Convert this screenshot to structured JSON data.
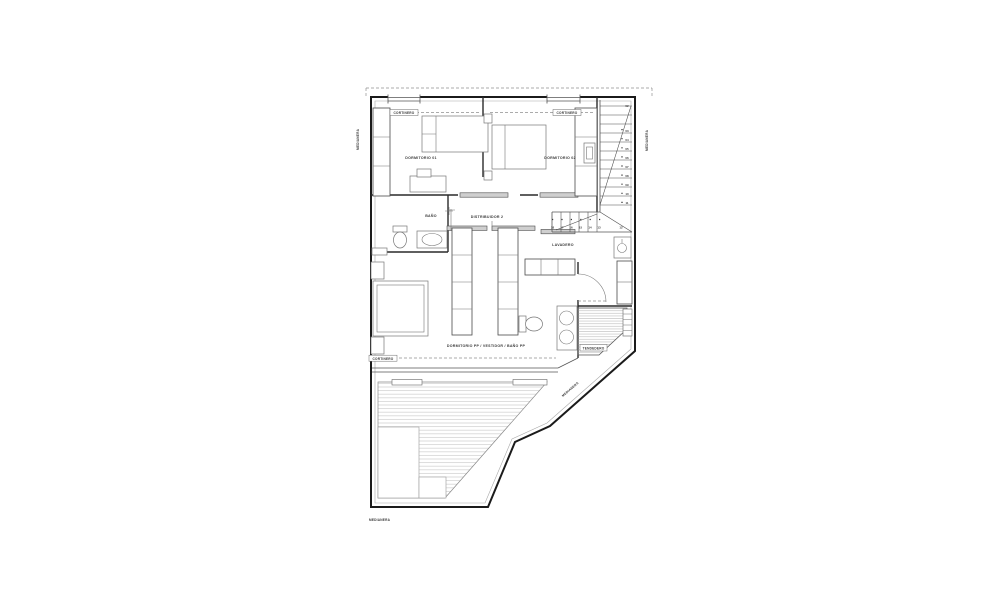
{
  "labels": {
    "dorm1": "DORMITORIO 01",
    "dorm2": "DORMITORIO 02",
    "bano": "BAÑO",
    "distribuidor": "DISTRIBUIDOR 2",
    "lavadero": "LAVADERO",
    "dormpp": "DORMITORIO PP / VESTIDOR / BAÑO PP",
    "tendedero": "TENDEDERO",
    "cortinero": "CORTINERO",
    "medianera": "MEDIANERA"
  },
  "stairs": {
    "upper_flight": [
      "02",
      "03",
      "04",
      "05",
      "06",
      "07",
      "08",
      "09",
      "10",
      "11"
    ],
    "lower_flight": [
      "18",
      "17",
      "16",
      "15",
      "14",
      "13",
      "12"
    ]
  },
  "colors": {
    "wall": "#1b1b1b",
    "furniture": "#777777",
    "hatch": "#c0c0c0",
    "label": "#3a3a3a"
  }
}
